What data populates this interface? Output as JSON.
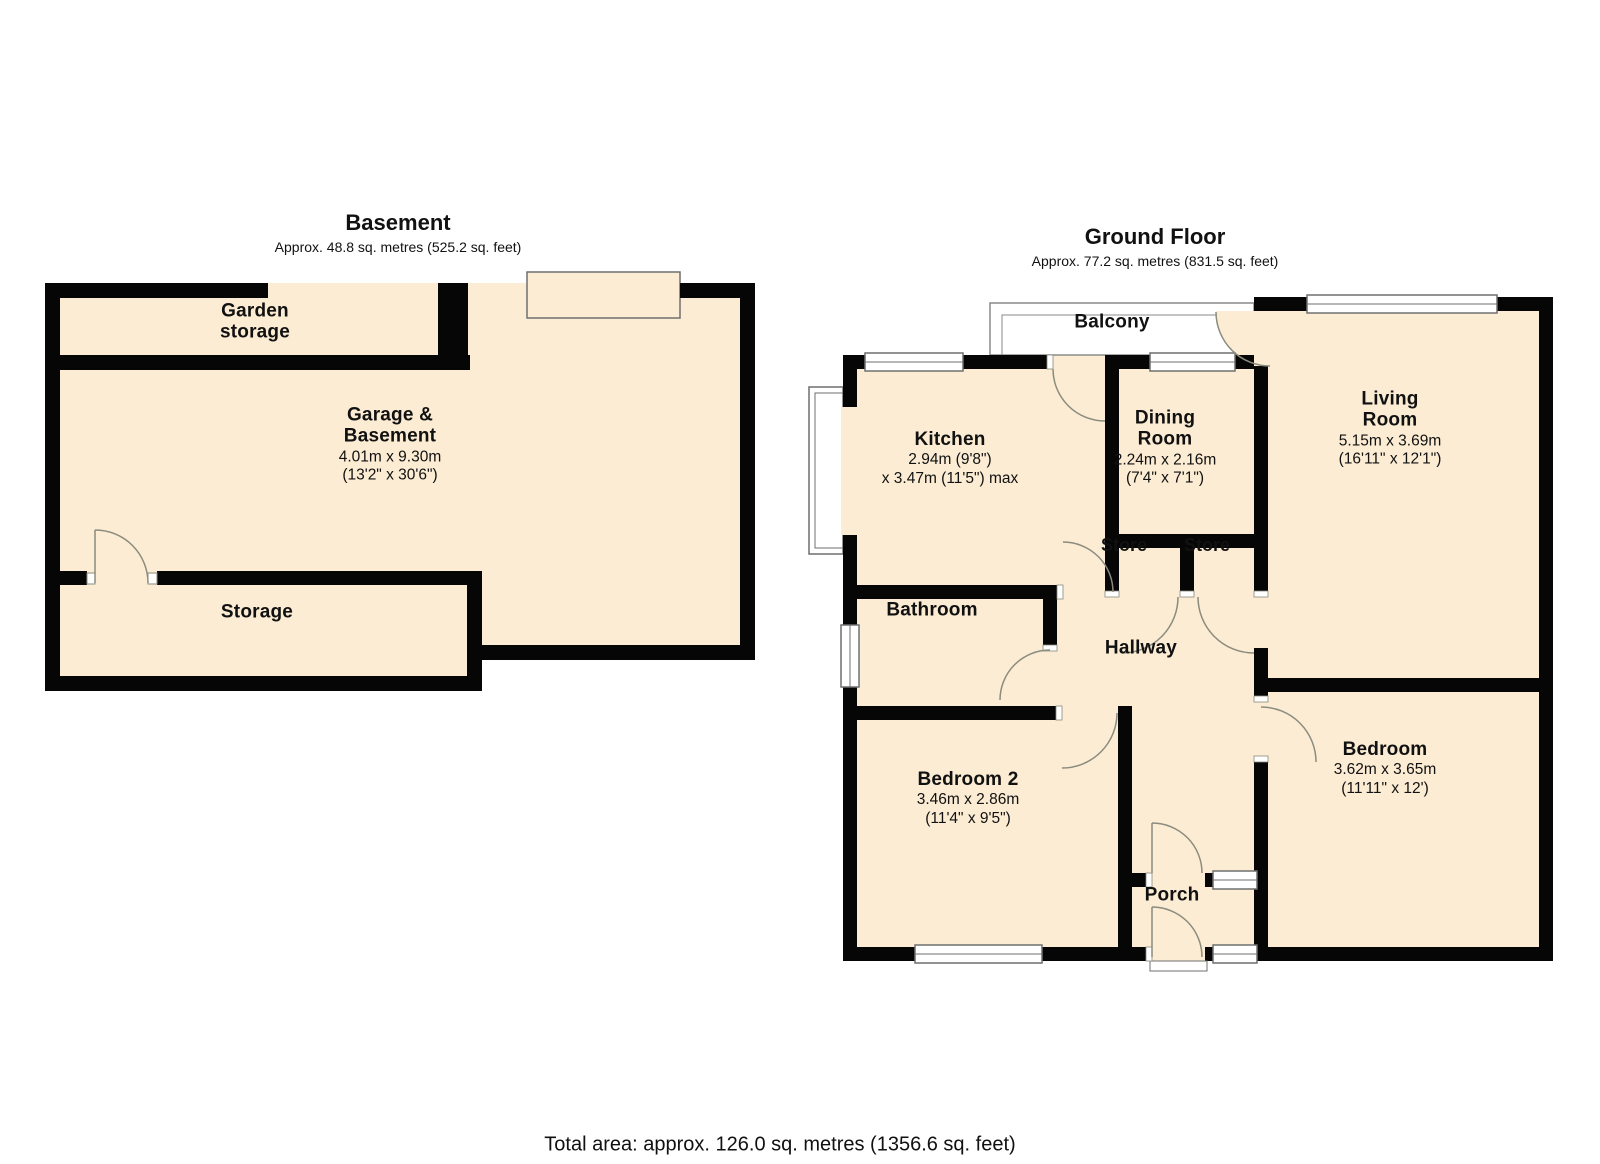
{
  "titles": {
    "basement": {
      "name": "Basement",
      "area": "Approx. 48.8 sq. metres (525.2 sq. feet)"
    },
    "ground": {
      "name": "Ground Floor",
      "area": "Approx. 77.2 sq. metres (831.5 sq. feet)"
    }
  },
  "total_area": "Total area: approx. 126.0 sq. metres (1356.6 sq. feet)",
  "colors": {
    "floor": "#fbecd3",
    "wall": "#060606",
    "door_arc": "#8b8b7e",
    "window_frame": "#6f6f6f",
    "balcony_line": "#8a8a8a"
  },
  "basement_rooms": {
    "garden_storage": {
      "name": "Garden storage"
    },
    "garage": {
      "name": "Garage & Basement",
      "dim_m": "4.01m x 9.30m",
      "dim_ft": "(13'2\" x 30'6\")"
    },
    "storage": {
      "name": "Storage"
    }
  },
  "ground_rooms": {
    "balcony": {
      "name": "Balcony"
    },
    "kitchen": {
      "name": "Kitchen",
      "dim_m": "2.94m (9'8\")",
      "dim_ft": "x 3.47m (11'5\") max"
    },
    "dining": {
      "name": "Dining Room",
      "dim_m": "2.24m x 2.16m",
      "dim_ft": "(7'4\" x 7'1\")"
    },
    "living": {
      "name": "Living Room",
      "dim_m": "5.15m x 3.69m",
      "dim_ft": "(16'11\" x 12'1\")"
    },
    "store1": {
      "name": "Store"
    },
    "store2": {
      "name": "Store"
    },
    "bathroom": {
      "name": "Bathroom"
    },
    "hallway": {
      "name": "Hallway"
    },
    "bedroom2": {
      "name": "Bedroom 2",
      "dim_m": "3.46m x 2.86m",
      "dim_ft": "(11'4\" x 9'5\")"
    },
    "bedroom": {
      "name": "Bedroom",
      "dim_m": "3.62m x 3.65m",
      "dim_ft": "(11'11\" x 12')"
    },
    "porch": {
      "name": "Porch"
    }
  }
}
